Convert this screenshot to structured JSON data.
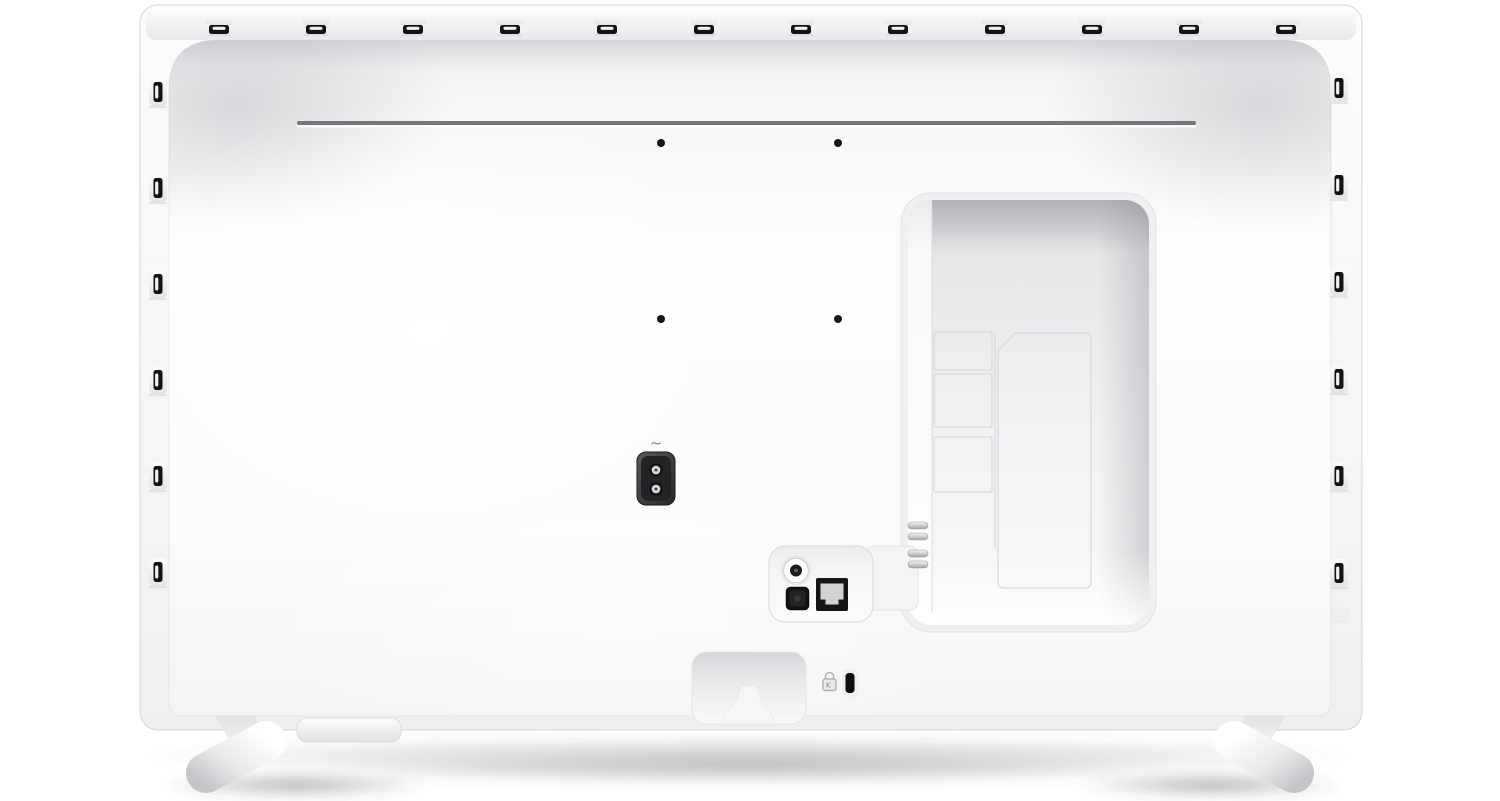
{
  "scene": {
    "description": "Rear view of a white flat-screen television standing on two oval feet",
    "background": "#ffffff"
  },
  "tv": {
    "power_inlet": {
      "symbol": "~",
      "kind": "2-pin AC power socket"
    },
    "ports": {
      "kinds": [
        "antenna-coax-port",
        "optical-audio-port",
        "ethernet-rj45-port"
      ]
    },
    "security": {
      "kind": "kensington-lock-slot"
    },
    "vents": {
      "top_count": 12,
      "left_count": 6,
      "right_count": 6
    },
    "vesa_holes": {
      "count": 4
    }
  },
  "colors": {
    "background": "#ffffff",
    "shell_edge": "#d6d6d9",
    "groove": "#75777a",
    "hole": "#151517",
    "vent_slot": "#131315",
    "vent_slit": "#f2f2f4",
    "kensington": "#0e0e10",
    "ethernet_inner": "#d3d3d6",
    "inlet_pin": "#d2d2d5"
  }
}
